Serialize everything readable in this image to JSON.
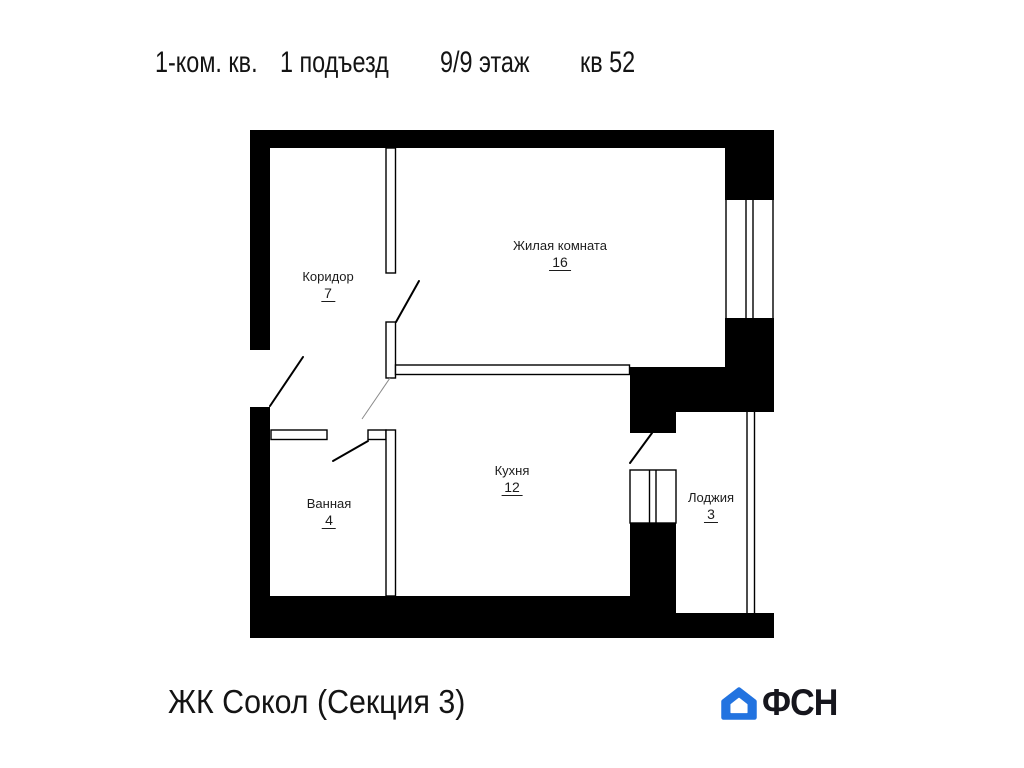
{
  "title": {
    "apartment_type": "1-ком. кв.",
    "entrance": "1 подъезд",
    "floor": "9/9 этаж",
    "apartment_number": "кв 52"
  },
  "rooms": [
    {
      "name": "Коридор",
      "area": "7"
    },
    {
      "name": "Жилая комната",
      "area": "16"
    },
    {
      "name": "Ванная",
      "area": "4"
    },
    {
      "name": "Кухня",
      "area": "12"
    },
    {
      "name": "Лоджия",
      "area": "3"
    }
  ],
  "footer": {
    "complex_name": "ЖК Сокол (Секция 3)",
    "logo_text": "ФСН"
  },
  "colors": {
    "plan_line": "#000000",
    "logo_blue": "#2273e0",
    "logo_dark": "#16161d"
  }
}
